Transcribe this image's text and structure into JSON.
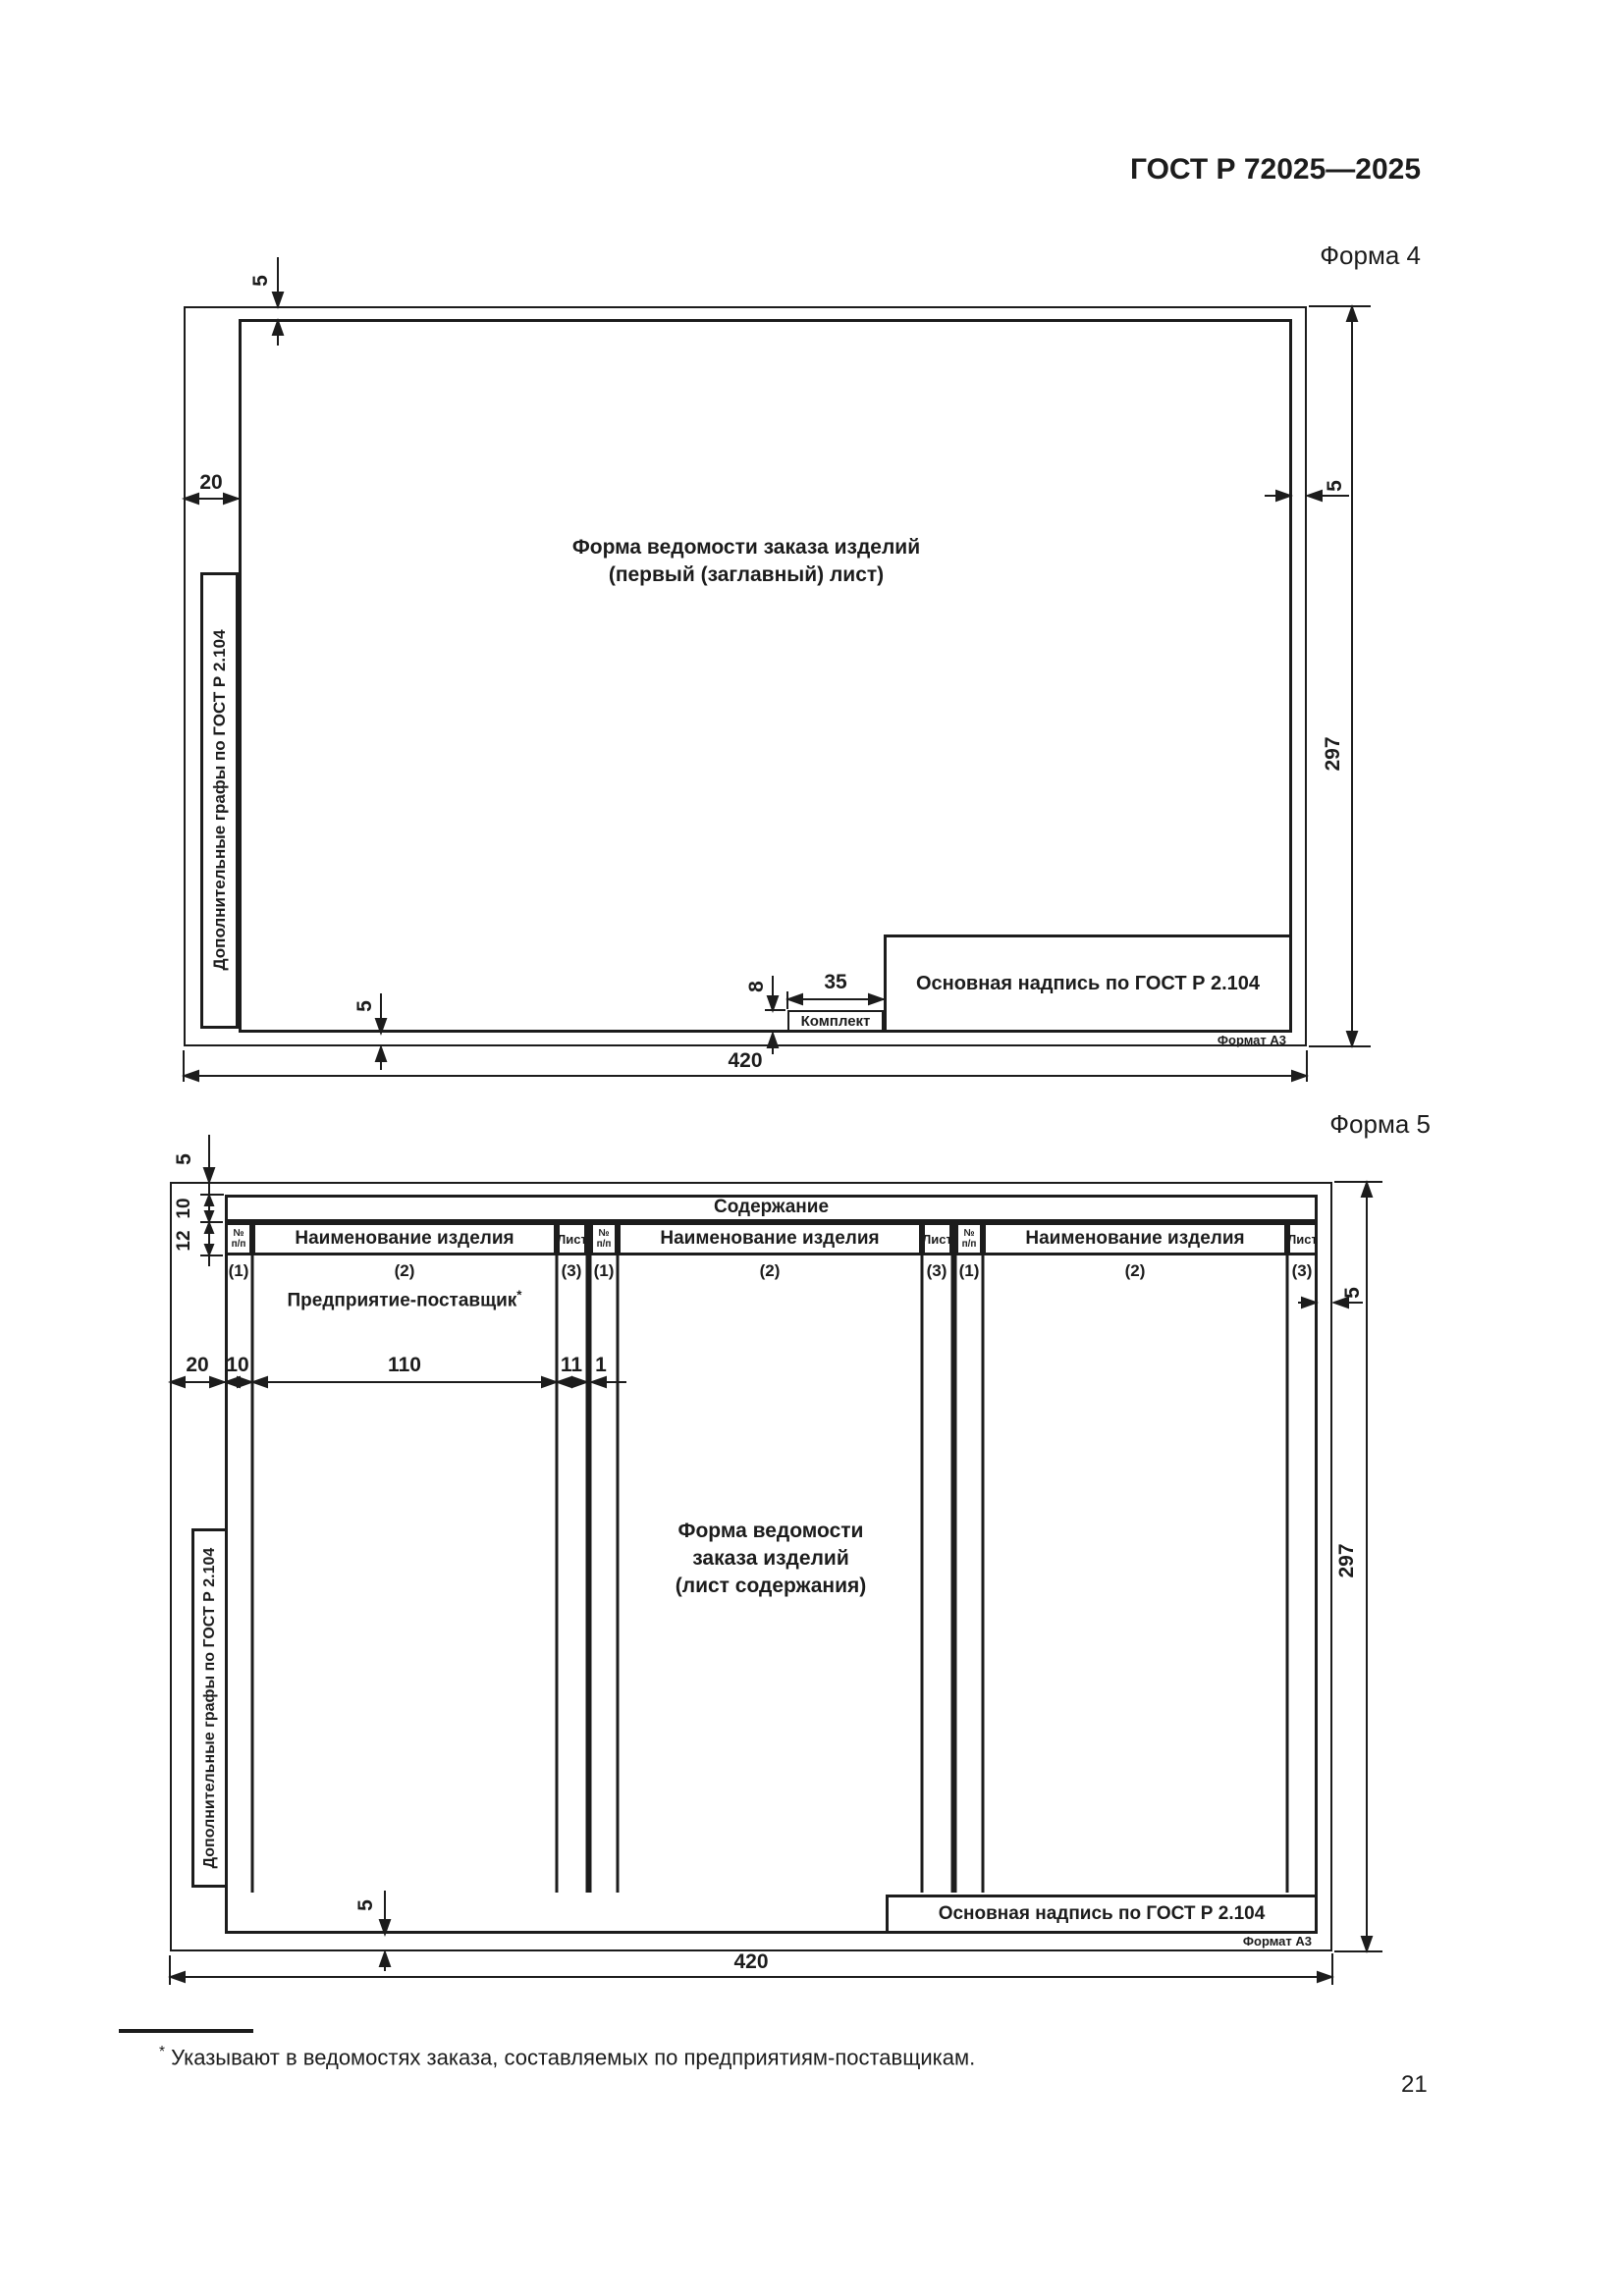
{
  "page_header": {
    "standard": "ГОСТ Р 72025—2025"
  },
  "form4": {
    "label": "Форма 4",
    "caption_line1": "Форма ведомости заказа изделий",
    "caption_line2": "(первый (заглавный) лист)",
    "side_box_label": "Дополнительные графы по ГОСТ Р 2.104",
    "title_block_label": "Основная надпись по ГОСТ Р 2.104",
    "komplekt_label": "Комплект",
    "format_label": "Формат А3",
    "dims": {
      "top_margin": "5",
      "left_margin": "20",
      "right_margin": "5",
      "height": "297",
      "width": "420",
      "komplekt_width": "35",
      "komplekt_height": "8",
      "bottom_margin": "5"
    }
  },
  "form5": {
    "label": "Форма 5",
    "table_title": "Содержание",
    "col_num_line1": "№",
    "col_num_line2": "п/п",
    "col_name": "Наименование изделия",
    "col_sheet": "Лист",
    "markers": [
      "(1)",
      "(2)",
      "(3)"
    ],
    "supplier_label": "Предприятие-поставщик",
    "supplier_marker": "*",
    "caption_line1": "Форма ведомости",
    "caption_line2": "заказа изделий",
    "caption_line3": "(лист содержания)",
    "side_box_label": "Дополнительные графы по ГОСТ Р 2.104",
    "title_block_label": "Основная надпись по ГОСТ Р 2.104",
    "format_label": "Формат А3",
    "dims": {
      "top_margin": "5",
      "row_title_height": "10",
      "row_header_height": "12",
      "left_margin": "20",
      "col_num_width": "10",
      "col_name_width": "110",
      "col_sheet_width": "11",
      "col_gap": "1",
      "right_margin": "5",
      "height": "297",
      "width": "420",
      "bottom_margin": "5"
    }
  },
  "footnote": {
    "marker": "*",
    "text": "Указывают в ведомостях заказа, составляемых по предприятиям-поставщикам."
  },
  "page_number": "21",
  "colors": {
    "ink": "#1c1c1c",
    "paper": "#ffffff"
  }
}
